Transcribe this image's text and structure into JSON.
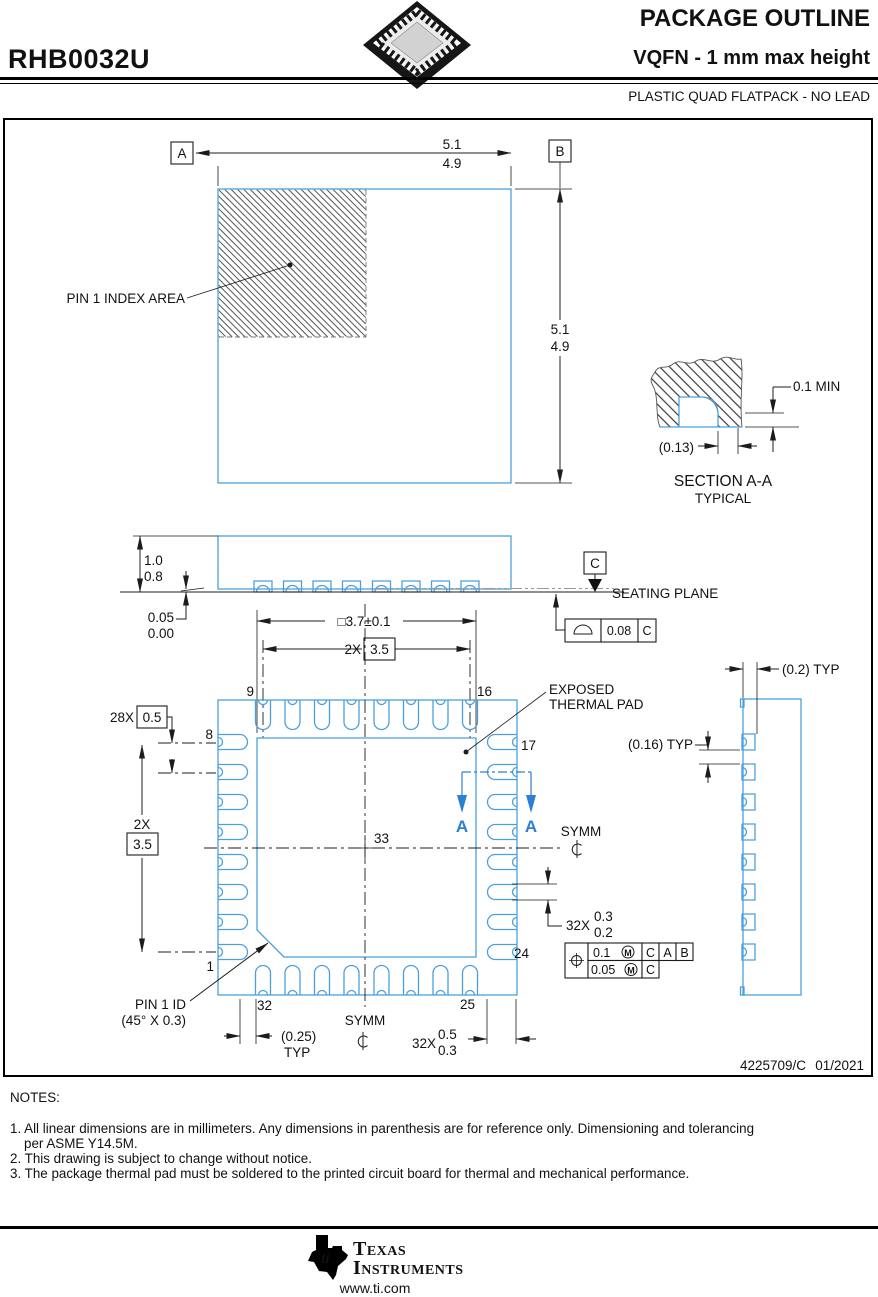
{
  "header": {
    "part_number": "RHB0032U",
    "title": "PACKAGE OUTLINE",
    "subtitle": "VQFN - 1 mm max height",
    "package_type": "PLASTIC QUAD FLATPACK - NO LEAD"
  },
  "top_view": {
    "width_max": "5.1",
    "width_min": "4.9",
    "height_max": "5.1",
    "height_min": "4.9",
    "datum_a": "A",
    "datum_b": "B",
    "pin1_index_label": "PIN 1 INDEX AREA"
  },
  "section_view": {
    "title": "SECTION A-A",
    "subtitle": "TYPICAL",
    "lead_thickness": "0.1 MIN",
    "lead_ref": "(0.13)"
  },
  "side_view": {
    "height_max": "1.0",
    "height_min": "0.8",
    "standoff_max": "0.05",
    "standoff_min": "0.00",
    "datum_c": "C",
    "seating_plane_label": "SEATING PLANE",
    "flatness_value": "0.08",
    "flatness_datum": "C"
  },
  "bottom_view": {
    "thermal_pad_dim": "□3.7±0.1",
    "span_count": "2X",
    "span_value": "3.5",
    "pitch_count": "28X",
    "pitch_value": "0.5",
    "exposed_line1": "EXPOSED",
    "exposed_line2": "THERMAL PAD",
    "symm_label": "SYMM",
    "section_label": "A",
    "pad_width_count": "32X",
    "pad_width_max": "0.3",
    "pad_width_min": "0.2",
    "pad_length_count": "32X",
    "pad_length_max": "0.5",
    "pad_length_min": "0.3",
    "pin1_id_line1": "PIN 1 ID",
    "pin1_id_line2": "(45° X 0.3)",
    "lead_edge_ref": "(0.25)",
    "typ_label": "TYP",
    "pins": {
      "n1": "1",
      "n8": "8",
      "n9": "9",
      "n16": "16",
      "n17": "17",
      "n24": "24",
      "n25": "25",
      "n32": "32",
      "n33": "33"
    },
    "fcf": {
      "position_tol": "0.1",
      "position_tol2": "0.05",
      "modifier": "M",
      "datum1": "C",
      "datum2": "A",
      "datum3": "B",
      "datum4": "C"
    }
  },
  "end_view": {
    "lead_depth_ref": "(0.2) TYP",
    "lead_gap_ref": "(0.16) TYP"
  },
  "title_block": {
    "doc_number": "4225709/C",
    "date": "01/2021"
  },
  "notes": {
    "heading": "NOTES:",
    "note1_line1": "1. All linear dimensions are in millimeters. Any dimensions in parenthesis are for reference only. Dimensioning and tolerancing",
    "note1_line2": "per ASME Y14.5M.",
    "note2": "2. This drawing is subject to change without notice.",
    "note3": "3. The package thermal pad must be soldered to the printed circuit board for thermal and mechanical performance."
  },
  "footer": {
    "brand_top": "Texas",
    "brand_bottom": "Instruments",
    "logo_text": "ti",
    "website": "www.ti.com"
  }
}
